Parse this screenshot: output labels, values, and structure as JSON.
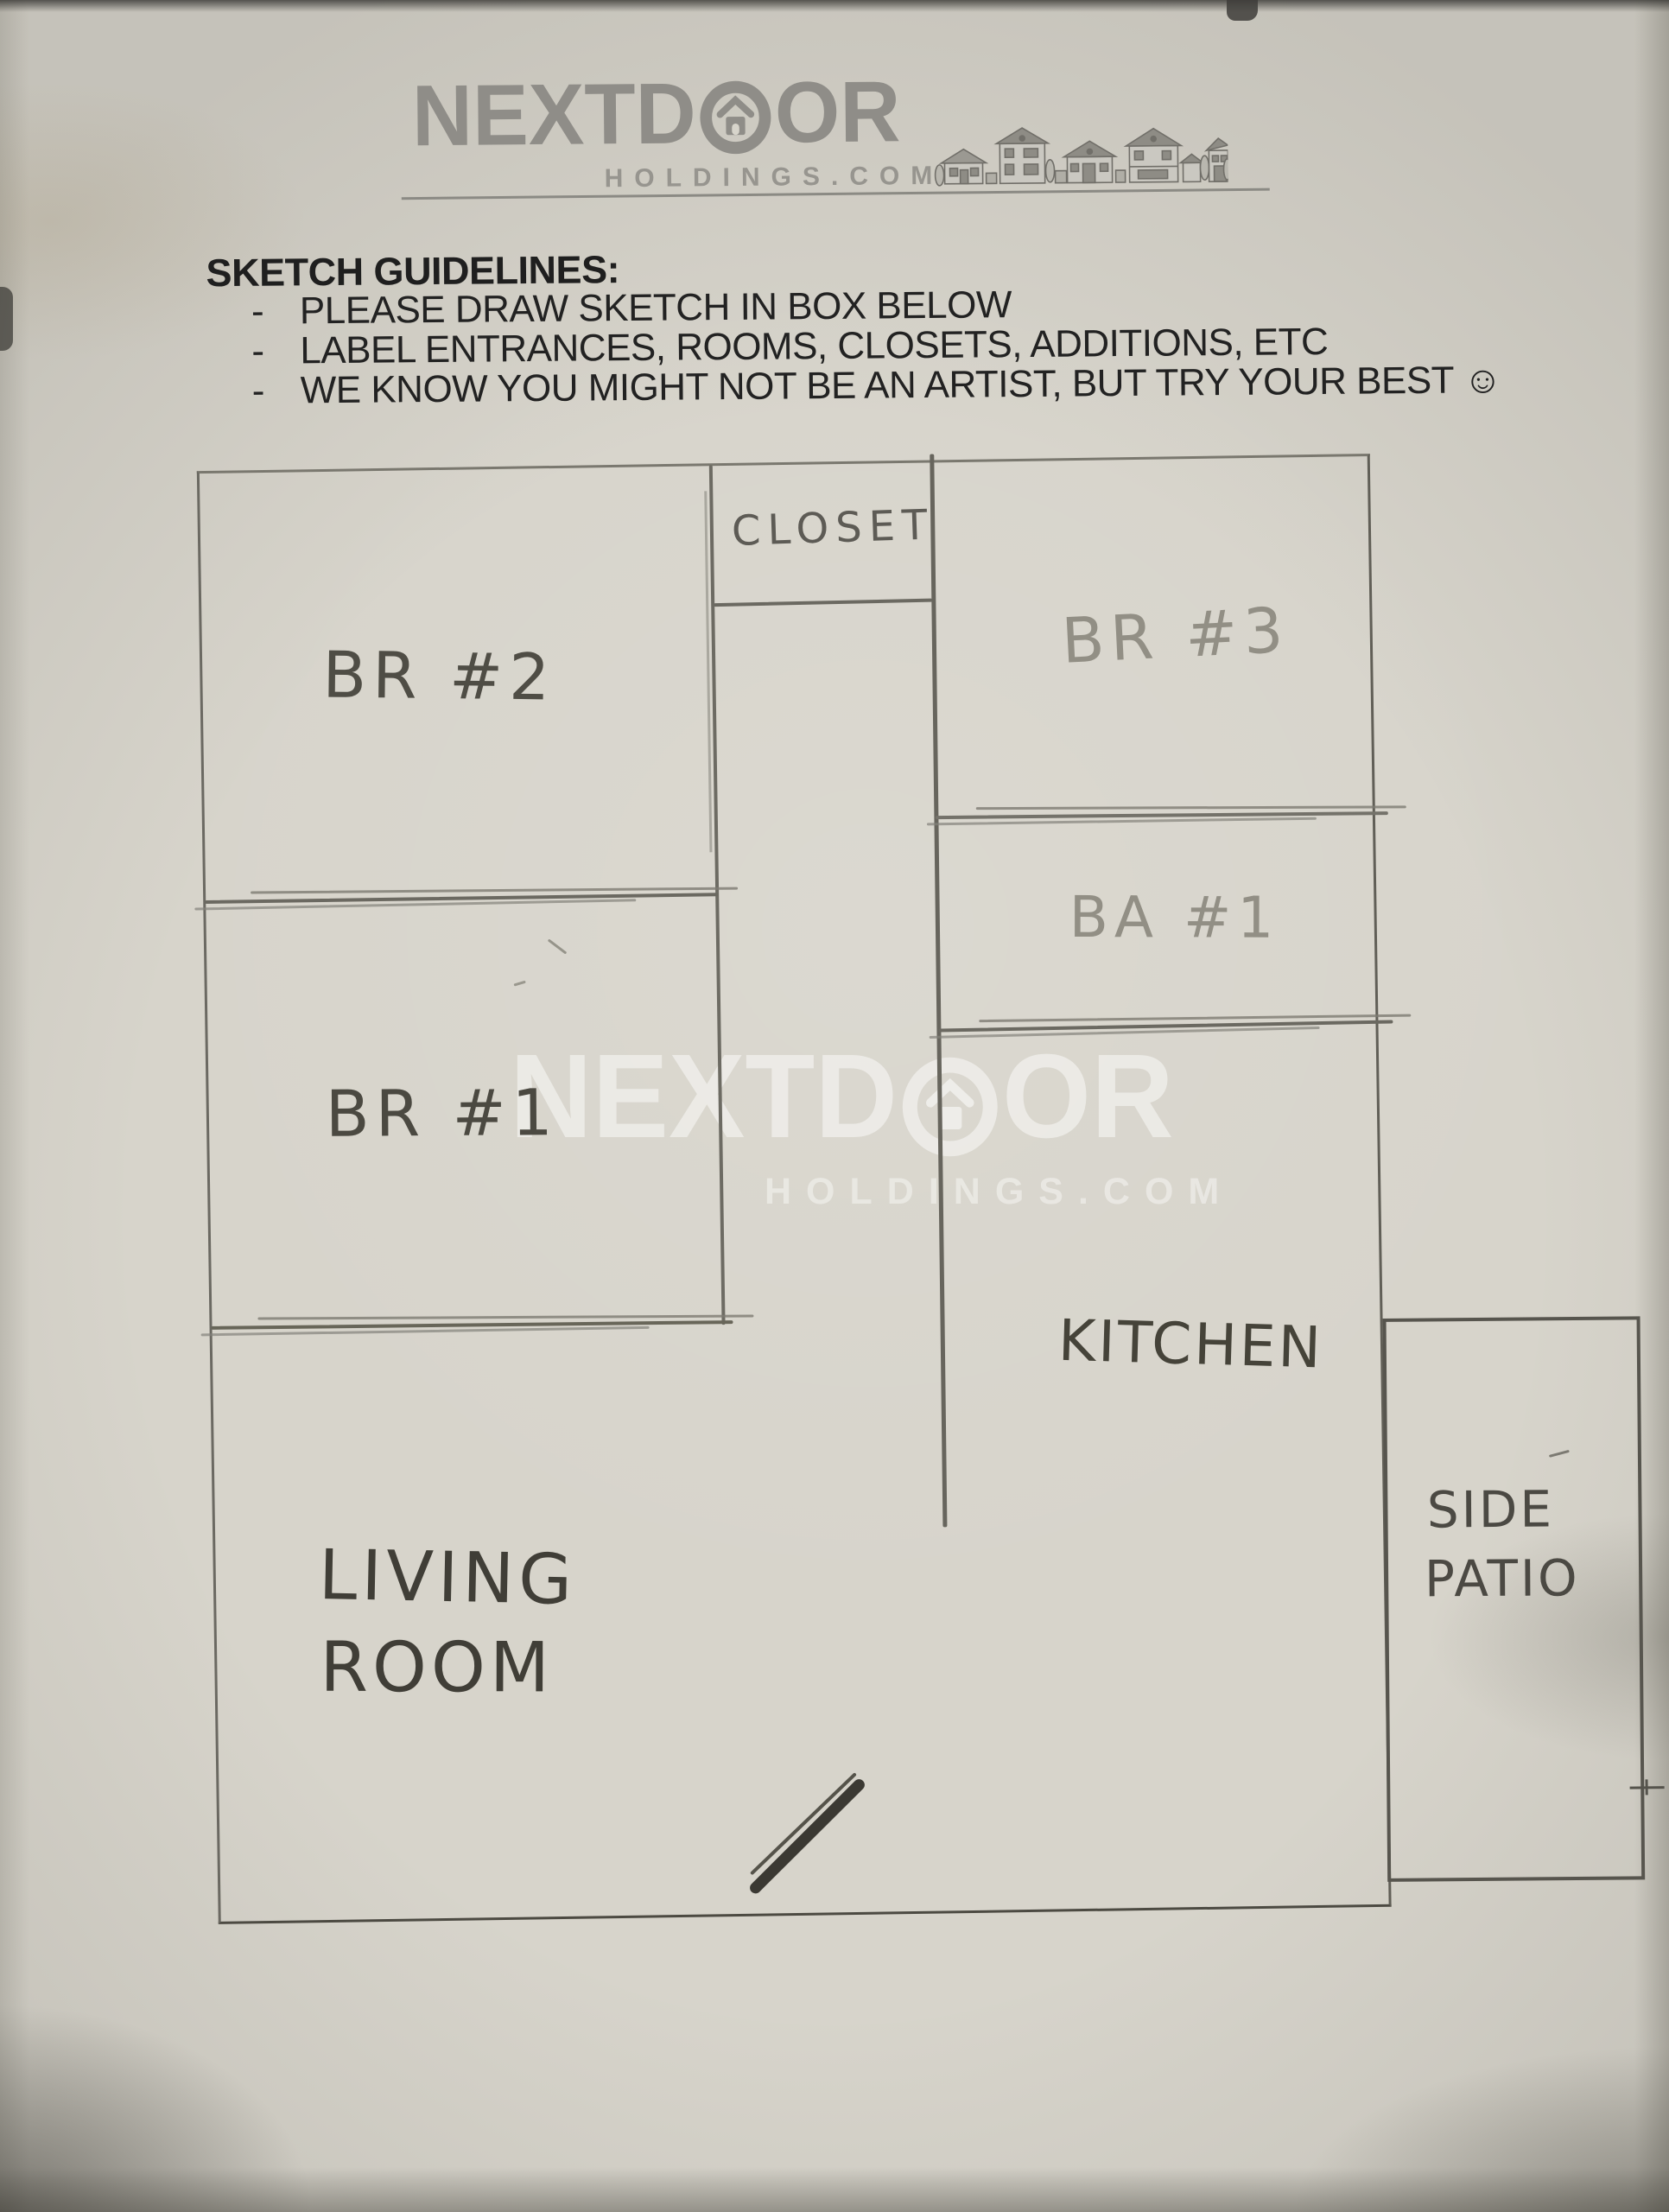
{
  "header": {
    "logo": {
      "prefix": "NEXTD",
      "suffix": "OR",
      "subtitle": "HOLDINGS.COM"
    }
  },
  "guidelines": {
    "title": "SKETCH GUIDELINES:",
    "bullet": "-",
    "items": [
      "PLEASE DRAW SKETCH IN BOX BELOW",
      "LABEL ENTRANCES, ROOMS, CLOSETS, ADDITIONS, ETC",
      "WE KNOW YOU MIGHT NOT BE AN ARTIST, BUT TRY YOUR BEST ☺"
    ]
  },
  "sketch": {
    "rooms": {
      "closet": "CLOSET",
      "br2": "BR #2",
      "br3": "BR #3",
      "ba1": "BA #1",
      "br1": "BR #1",
      "kitchen": "KITCHEN",
      "living_line1": "LIVING",
      "living_line2": "ROOM",
      "patio_line1": "SIDE",
      "patio_line2": "PATIO"
    }
  },
  "watermark": {
    "prefix": "NEXTD",
    "suffix": "OR",
    "subtitle": "HOLDINGS.COM"
  },
  "colors": {
    "paper": "#d7d4cb",
    "pencil": "#6b6961",
    "pencil_light": "#928f85",
    "ink": "#3b3933",
    "print_black": "#1f1f1f",
    "logo_gray": "#8f8d88",
    "watermark_white": "rgba(255,255,255,0.48)"
  }
}
